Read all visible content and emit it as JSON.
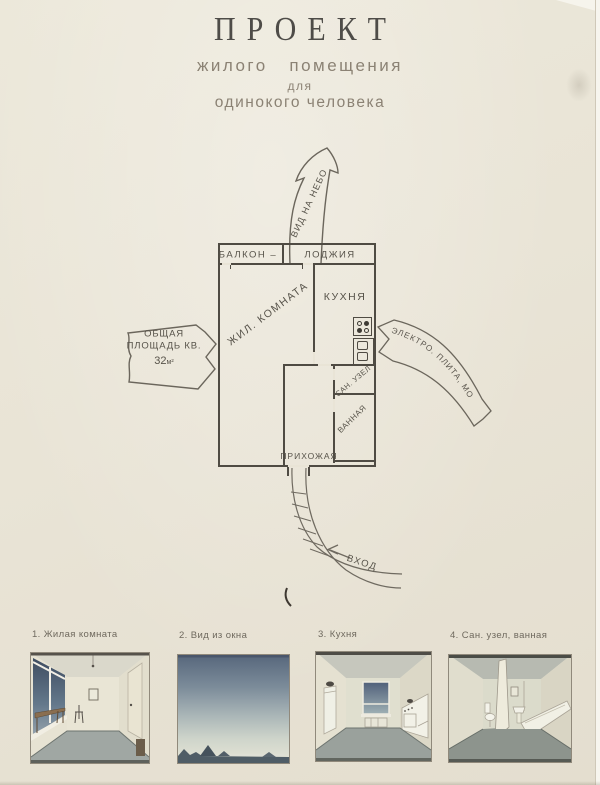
{
  "poster": {
    "title": "ПРОЕКТ",
    "subtitle_line1": "жилого   помещения",
    "subtitle_line2": "для",
    "subtitle_line3": "одинокого человека"
  },
  "plan": {
    "rooms": {
      "balcony": "БАЛКОН –",
      "loggia": "ЛОДЖИЯ",
      "living_room": "ЖИЛ. КОМНАТА",
      "kitchen": "КУХНЯ",
      "san_uzel": "САН. УЗЕЛ",
      "bathroom": "ВАННАЯ",
      "hallway": "ПРИХОЖАЯ"
    },
    "annotations": {
      "sky_view": "ВИД НА НЕБО",
      "area_line1": "ОБЩАЯ",
      "area_line2": "ПЛОЩАДЬ КВ.",
      "area_value": "32",
      "area_unit": "м²",
      "utilities": "ЭЛЕКТРО. ПЛИТА, МОЙКА",
      "entrance": "ВХОД"
    }
  },
  "thumbnails": [
    {
      "caption": "1. Жилая комната"
    },
    {
      "caption": "2. Вид из окна"
    },
    {
      "caption": "3. Кухня"
    },
    {
      "caption": "4. Сан. узел, ванная"
    }
  ],
  "colors": {
    "paper": "#e9e4d6",
    "ink": "#4f4b43",
    "title_ink": "#4e4c48",
    "subtitle_ink": "#8b8274",
    "sky_dark": "#57677c",
    "floor_gray": "#9aa19c"
  }
}
